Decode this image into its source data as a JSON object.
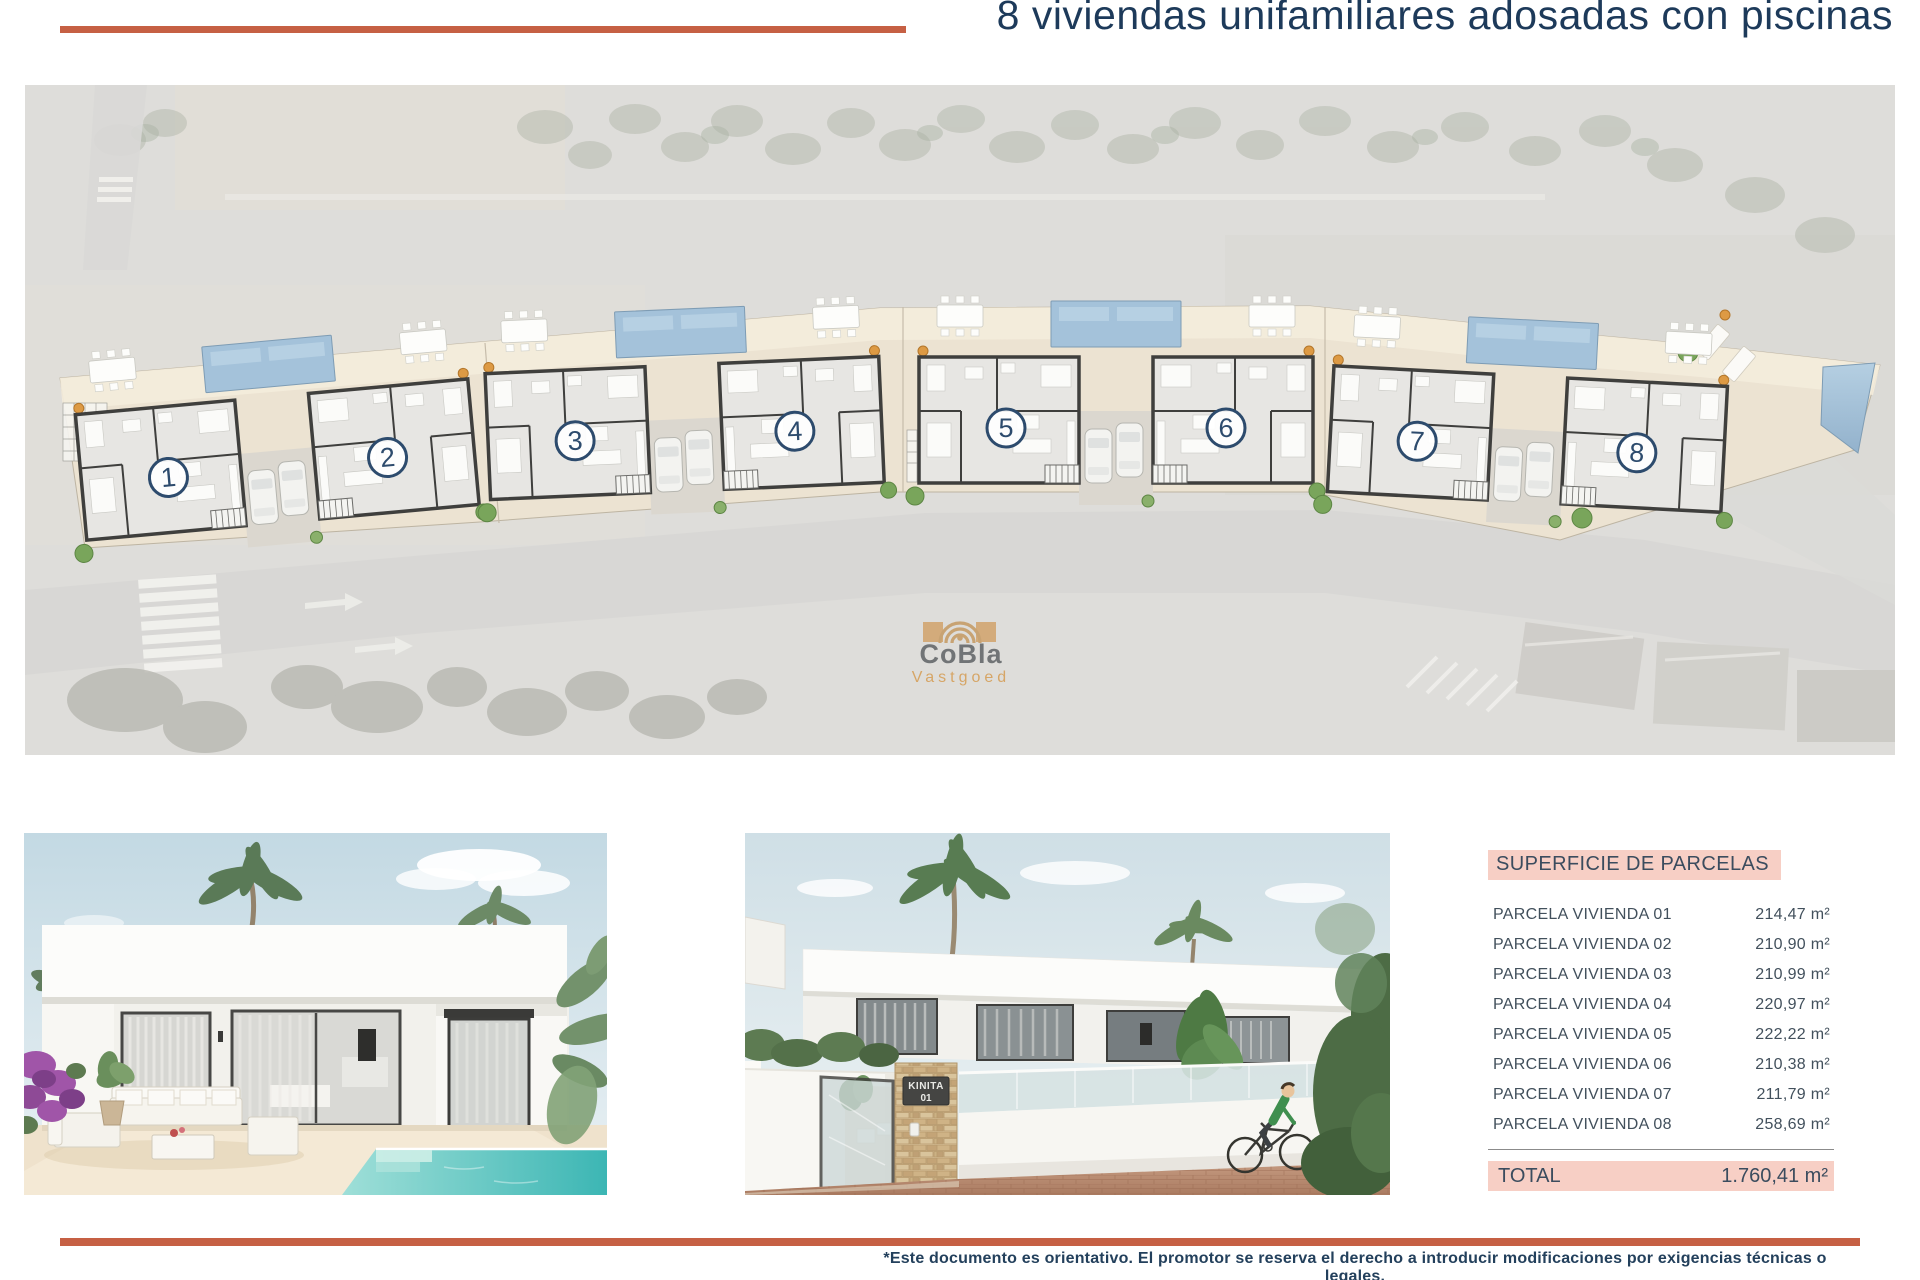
{
  "page": {
    "title": "8 viviendas unifamiliares adosadas con piscinas"
  },
  "site_plan": {
    "units": [
      {
        "number": "1"
      },
      {
        "number": "2"
      },
      {
        "number": "3"
      },
      {
        "number": "4"
      },
      {
        "number": "5"
      },
      {
        "number": "6"
      },
      {
        "number": "7"
      },
      {
        "number": "8"
      }
    ],
    "watermark": {
      "brand": "CoBla",
      "subtitle": "Vastgoed"
    }
  },
  "renders": {
    "street": {
      "sign_line1": "KINITA",
      "sign_line2": "01"
    }
  },
  "surface_table": {
    "title": "SUPERFICIE DE PARCELAS",
    "rows": [
      {
        "label": "PARCELA VIVIENDA 01",
        "value": "214,47 m²"
      },
      {
        "label": "PARCELA VIVIENDA 02",
        "value": "210,90 m²"
      },
      {
        "label": "PARCELA VIVIENDA 03",
        "value": "210,99 m²"
      },
      {
        "label": "PARCELA VIVIENDA 04",
        "value": "220,97 m²"
      },
      {
        "label": "PARCELA VIVIENDA 05",
        "value": "222,22 m²"
      },
      {
        "label": "PARCELA VIVIENDA 06",
        "value": "210,38 m²"
      },
      {
        "label": "PARCELA VIVIENDA 07",
        "value": "211,79 m²"
      },
      {
        "label": "PARCELA VIVIENDA 08",
        "value": "258,69 m²"
      }
    ],
    "total": {
      "label": "TOTAL",
      "value": "1.760,41 m²"
    }
  },
  "footer": {
    "line1": "*Este documento es orientativo. El promotor se reserva el derecho a introducir modificaciones por exigencias técnicas o legales.",
    "line2": "This document is indicative. The promoter reserves the right to introduce modifications due to technical or legal requirements."
  },
  "colors": {
    "accent_orange": "#c66044",
    "title_navy": "#1d3a5a",
    "table_pink": "#f7cfc5",
    "pool_blue": "#a4c2da",
    "unit_circle_navy": "#2d4b6d",
    "watermark_tan": "#d2a36b"
  }
}
